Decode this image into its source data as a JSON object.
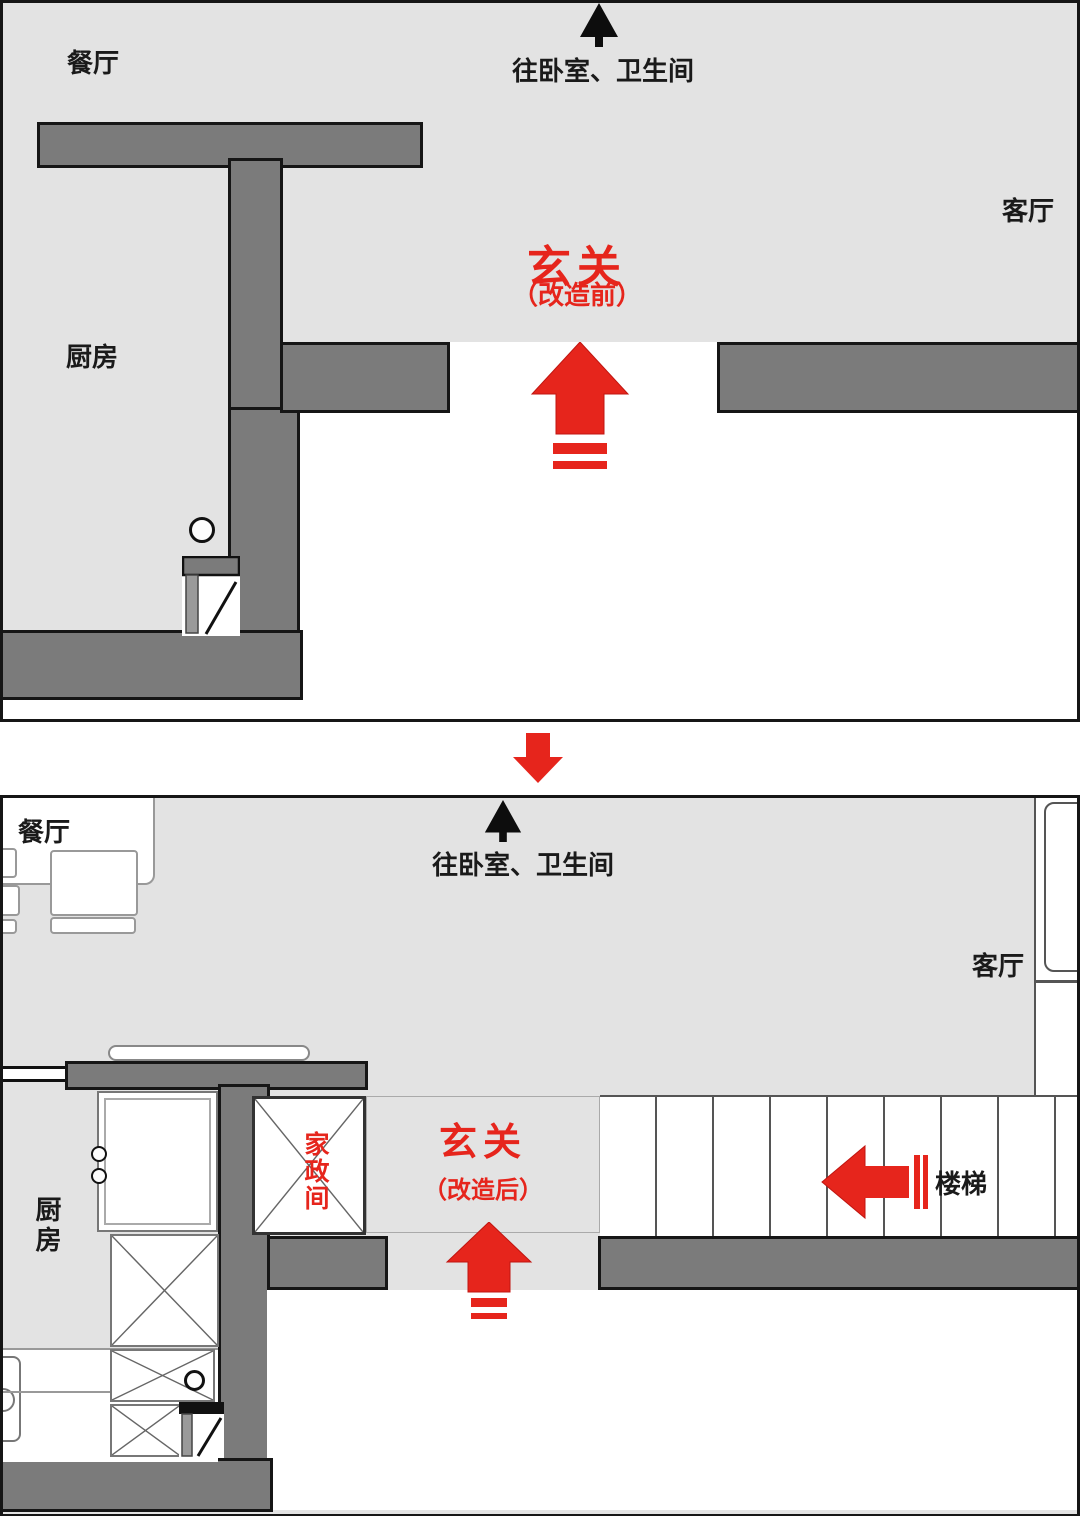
{
  "colors": {
    "floor": "#e3e3e3",
    "wall": "#7b7b7b",
    "outline": "#161616",
    "red": "#e6251c",
    "line": "#999999"
  },
  "panel_before": {
    "title": "玄关",
    "subtitle": "（改造前）",
    "nav_note": "往卧室、卫生间",
    "rooms": {
      "dining": "餐厅",
      "kitchen": "厨房",
      "living": "客厅"
    }
  },
  "panel_after": {
    "title": "玄关",
    "subtitle": "（改造后）",
    "nav_note": "往卧室、卫生间",
    "rooms": {
      "dining": "餐厅",
      "kitchen": "厨房",
      "living": "客厅",
      "laundry": "家政间",
      "stairs": "楼梯"
    }
  }
}
